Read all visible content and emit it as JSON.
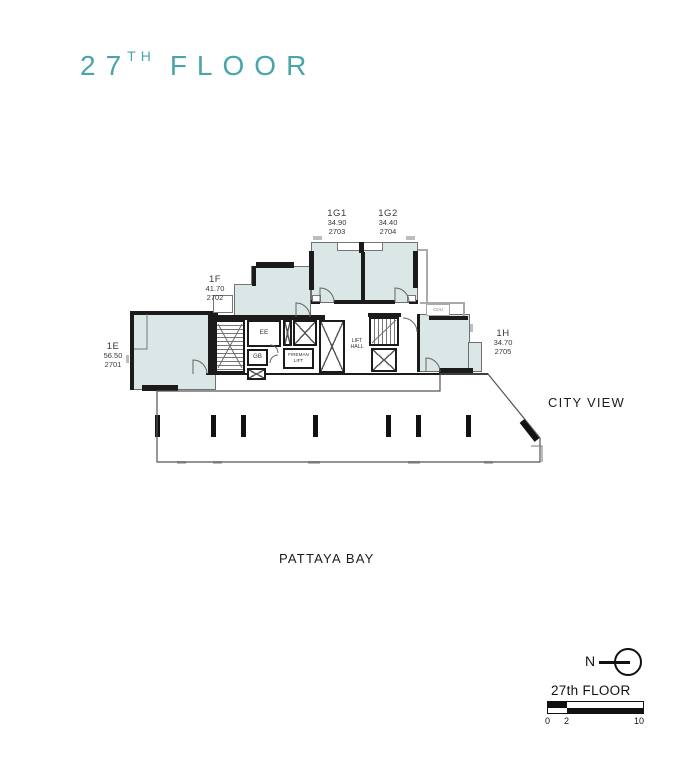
{
  "title": {
    "number": "27",
    "sup": "TH",
    "word": "FLOOR"
  },
  "plan": {
    "units": [
      {
        "id": "1E",
        "area": "56.50",
        "unit_no": "2701"
      },
      {
        "id": "1F",
        "area": "41.70",
        "unit_no": "2702"
      },
      {
        "id": "1G1",
        "area": "34.90",
        "unit_no": "2703"
      },
      {
        "id": "1G2",
        "area": "34.40",
        "unit_no": "2704"
      },
      {
        "id": "1H",
        "area": "34.70",
        "unit_no": "2705"
      }
    ],
    "core": {
      "ee": "EE",
      "gb": "GB",
      "fireman_l1": "FIREMAN",
      "fireman_l2": "LIFT",
      "lifthall_l1": "LIFT",
      "lifthall_l2": "HALL",
      "cdu": "CDU"
    },
    "annotations": {
      "city_view": "CITY VIEW",
      "bay": "PATTAYA BAY"
    }
  },
  "legend": {
    "north": "N",
    "floor_label": "27th FLOOR",
    "scale_ticks": [
      "0",
      "2",
      "10"
    ]
  },
  "colors": {
    "accent": "#4BA5A8",
    "room_fill": "#DAE7E6",
    "wall": "#1B1B1B"
  }
}
